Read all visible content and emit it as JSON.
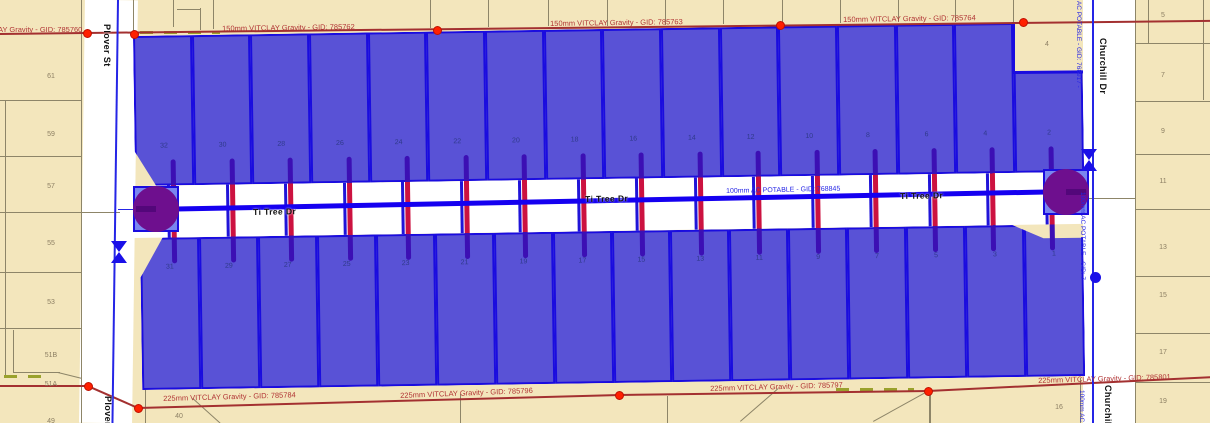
{
  "map": {
    "streets": {
      "west": "Plover St",
      "center": "Ti Tree Dr",
      "east": "Churchill Dr"
    },
    "sewer_labels": {
      "top_left": "AY Gravity - GID: 785760",
      "top_mid_1": "150mm VITCLAY Gravity - GID: 785762",
      "top_mid_2": "150mm VITCLAY Gravity - GID: 785763",
      "top_right": "150mm VITCLAY Gravity - GID: 785764",
      "bottom_left": "225mm VITCLAY Gravity - GID: 785784",
      "bottom_mid_1": "225mm VITCLAY Gravity - GID: 785796",
      "bottom_mid_2": "225mm VITCLAY Gravity - GID: 785797",
      "bottom_right": "225mm VITCLAY Gravity - GID: 785801"
    },
    "water_labels": {
      "center": "100mm AC POTABLE - GID: 768845",
      "east_top": "m AC POTABLE - GID: 768917 -",
      "east_mid": "100mm AC POTABLE - GID: 76895",
      "east_bottom": "100mm AC POTABLE"
    },
    "lots": {
      "selected_north": [
        "32",
        "30",
        "28",
        "26",
        "24",
        "22",
        "20",
        "18",
        "16",
        "14",
        "12",
        "10",
        "8",
        "6",
        "4",
        "2"
      ],
      "selected_south": [
        "31",
        "29",
        "27",
        "25",
        "23",
        "21",
        "19",
        "17",
        "15",
        "13",
        "11",
        "9",
        "7",
        "5",
        "3",
        "1"
      ],
      "west": [
        "61",
        "59",
        "57",
        "55",
        "53",
        "51B",
        "51A",
        "49"
      ],
      "east": [
        "5",
        "7",
        "9",
        "11",
        "13",
        "15",
        "17",
        "19"
      ],
      "east_corner": "4",
      "south_1": "40",
      "south_2": "16"
    },
    "colors": {
      "parcel_cream": "#f3e6bc",
      "road_white": "#ffffff",
      "boundary_gray": "#8d8568",
      "lot_blue_fill": "#5952d6",
      "lot_blue_border": "#1a0cdf",
      "water_blue": "#1500f0",
      "potable_label_blue": "#2525e6",
      "sewer_red": "#a33030",
      "sewer_label_red": "#b13535",
      "junction_red": "#ff2000",
      "manhole_purple": "#6e0f8e",
      "pump_square_blue": "#7a86ef",
      "service_crimson": "#cc1240",
      "service_purple": "#3c0fb4",
      "dashed_olive": "#9aa12c"
    }
  }
}
